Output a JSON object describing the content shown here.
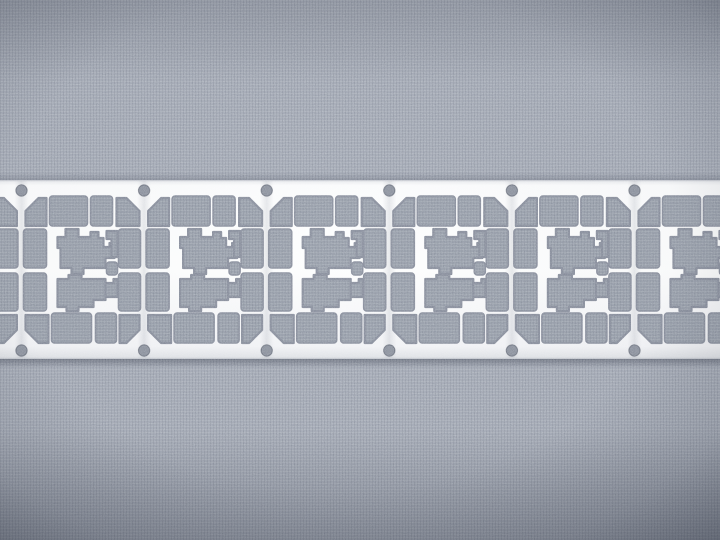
{
  "scene": {
    "description": "Macro photograph of a continuous stamped metal lead-frame strip with six repeating smart-card contact patterns, laid horizontally on gray woven fabric",
    "object": "metal-leadframe-strip",
    "units_visible": 6
  },
  "palette": {
    "fabric_base": "#a4aab6",
    "fabric_thread_light": "rgba(255,255,255,0.10)",
    "fabric_thread_dark": "rgba(56,62,78,0.10)",
    "fabric_cutout": "#99a0ac",
    "metal_top_edge": "#e7e9ed",
    "metal_bright": "#fbfcfd",
    "metal_mid": "#fdfefe",
    "metal_low": "#f3f4f7",
    "metal_bottom_edge": "#dfe2e6",
    "metal_edge_line": "#c2c6cd",
    "cutout_edge": "#8a909e",
    "hole_fill": "#8e94a0",
    "hole_edge": "rgba(58,64,80,0.45)",
    "shadow": "rgba(40,46,62,0.38)",
    "vignette": "rgba(20,26,40,0.34)"
  },
  "canvas": {
    "width": 720,
    "height": 540
  },
  "strip": {
    "top": 180,
    "height": 179,
    "edge_line_thickness": 1.2
  },
  "unit": {
    "pitch": 122.6,
    "origin_x": 21.5,
    "indices": [
      -1,
      0,
      1,
      2,
      3,
      4,
      5
    ],
    "holes": [
      {
        "cx": 0,
        "cy": 190.5,
        "r": 5.7
      },
      {
        "cx": 0,
        "cy": 350.5,
        "r": 5.7
      }
    ],
    "rail_shade": {
      "x": -7,
      "y": 181,
      "w": 14,
      "h": 177
    },
    "rects": [
      {
        "x": 28,
        "y": 196,
        "w": 38,
        "h": 30
      },
      {
        "x": 69,
        "y": 196,
        "w": 22,
        "h": 30
      },
      {
        "x": 30,
        "y": 313,
        "w": 40,
        "h": 30
      },
      {
        "x": 74,
        "y": 313,
        "w": 21,
        "h": 30
      },
      {
        "x": 2,
        "y": 229,
        "w": 23,
        "h": 39
      },
      {
        "x": 2,
        "y": 273,
        "w": 23,
        "h": 38
      },
      {
        "x": 97,
        "y": 229,
        "w": 22,
        "h": 39
      },
      {
        "x": 97,
        "y": 273,
        "w": 22,
        "h": 38
      },
      {
        "x": 85,
        "y": 262,
        "w": 11,
        "h": 13
      }
    ],
    "corner_radius": 3,
    "paths": [
      "M17,198 L25,198 L25,226 L4,226 L4,211 Z",
      "M95,198 L105,198 L118,211 L118,226 L95,226 Z",
      "M4,315 L27,315 L27,343 L17,343 L4,330 Z",
      "M98,315 L118,315 L118,330 L105,343 L98,343 Z",
      "M44,229 h13 v8 h12 v-5 h8 v6 h5 v9 h6 v-4 h5 v15 h-9 v10 h-22 v6 h-12 v-6 h-11 v-20 h-3 v-11 h8 z",
      "M36,279 h11 v-4 h13 v4 h24 v5 h6 v12 h-6 v4 h-12 v7 h-15 v4 h-12 v-4 h-9 z",
      "M85,231 h11 v26 h-6 v-18 h-5 z",
      "M84,283 h8 v-4 h4 v18 h-12 z"
    ]
  }
}
